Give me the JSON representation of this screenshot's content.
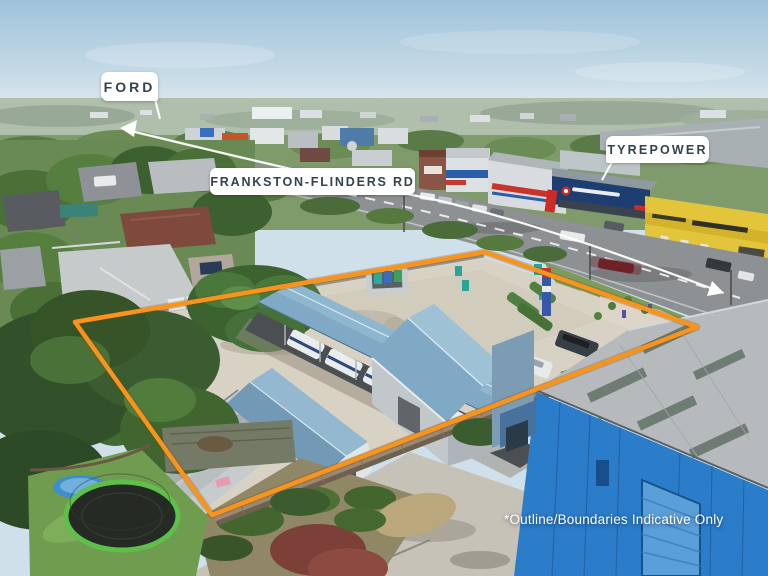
{
  "annotations": {
    "ford": "FORD",
    "road": "FRANKSTON-FLINDERS RD",
    "tyrepower": "TYREPOWER",
    "disclaimer": "*Outline/Boundaries Indicative Only"
  },
  "colors": {
    "boundary": "#F7941E",
    "annotation_line": "#FFFFFF",
    "label_background": "#FFFFFF",
    "label_text": "#33424D",
    "disclaimer_text": "#FFFFFF",
    "warehouse_blue": "#2B7CC9",
    "shed_roof_blue": "#7FA9C4",
    "tyrepower_navy": "#1E3E72",
    "brand_red": "#CE2B28",
    "produce_store_yellow": "#E3C53C"
  }
}
